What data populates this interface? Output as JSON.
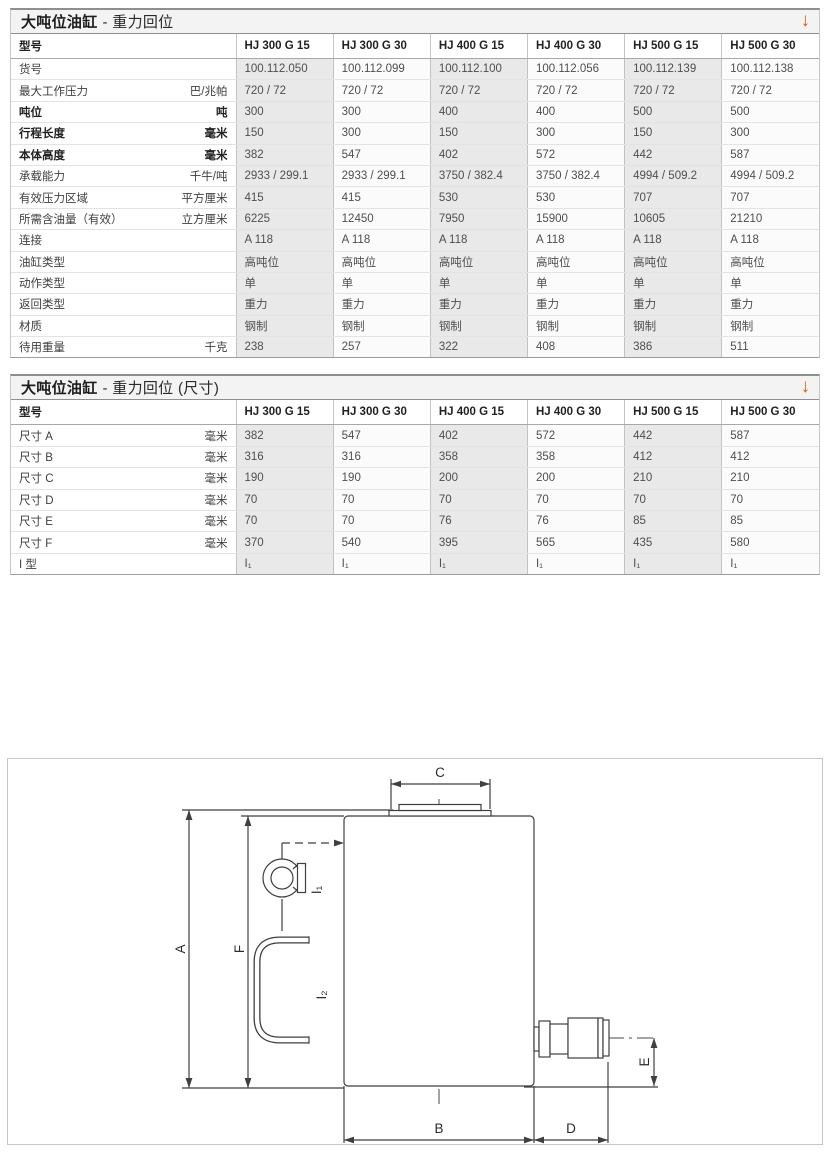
{
  "accent_color": "#e8590c",
  "page_background": "#ffffff",
  "table1": {
    "title_bold": "大吨位油缸",
    "title_rest": "- 重力回位",
    "arrow_glyph": "↓",
    "model_header": "型号",
    "columns": [
      "HJ 300 G 15",
      "HJ 300 G 30",
      "HJ 400 G 15",
      "HJ 400 G 30",
      "HJ 500 G 15",
      "HJ 500 G 30"
    ],
    "rows": [
      {
        "label": "货号",
        "unit": "",
        "bold": false,
        "values": [
          "100.112.050",
          "100.112.099",
          "100.112.100",
          "100.112.056",
          "100.112.139",
          "100.112.138"
        ]
      },
      {
        "label": "最大工作压力",
        "unit": "巴/兆帕",
        "bold": false,
        "values": [
          "720 / 72",
          "720 / 72",
          "720 / 72",
          "720 / 72",
          "720 / 72",
          "720 / 72"
        ]
      },
      {
        "label": "吨位",
        "unit": "吨",
        "bold": true,
        "values": [
          "300",
          "300",
          "400",
          "400",
          "500",
          "500"
        ]
      },
      {
        "label": "行程长度",
        "unit": "毫米",
        "bold": true,
        "values": [
          "150",
          "300",
          "150",
          "300",
          "150",
          "300"
        ]
      },
      {
        "label": "本体高度",
        "unit": "毫米",
        "bold": true,
        "values": [
          "382",
          "547",
          "402",
          "572",
          "442",
          "587"
        ]
      },
      {
        "label": "承载能力",
        "unit": "千牛/吨",
        "bold": false,
        "values": [
          "2933 / 299.1",
          "2933 / 299.1",
          "3750 / 382.4",
          "3750 / 382.4",
          "4994 / 509.2",
          "4994 / 509.2"
        ]
      },
      {
        "label": "有效压力区域",
        "unit": "平方厘米",
        "bold": false,
        "values": [
          "415",
          "415",
          "530",
          "530",
          "707",
          "707"
        ]
      },
      {
        "label": "所需含油量（有效）",
        "unit": "立方厘米",
        "bold": false,
        "values": [
          "6225",
          "12450",
          "7950",
          "15900",
          "10605",
          "21210"
        ]
      },
      {
        "label": "连接",
        "unit": "",
        "bold": false,
        "values": [
          "A 118",
          "A 118",
          "A 118",
          "A 118",
          "A 118",
          "A 118"
        ]
      },
      {
        "label": "油缸类型",
        "unit": "",
        "bold": false,
        "values": [
          "高吨位",
          "高吨位",
          "高吨位",
          "高吨位",
          "高吨位",
          "高吨位"
        ]
      },
      {
        "label": "动作类型",
        "unit": "",
        "bold": false,
        "values": [
          "单",
          "单",
          "单",
          "单",
          "单",
          "单"
        ]
      },
      {
        "label": "返回类型",
        "unit": "",
        "bold": false,
        "values": [
          "重力",
          "重力",
          "重力",
          "重力",
          "重力",
          "重力"
        ]
      },
      {
        "label": "材质",
        "unit": "",
        "bold": false,
        "values": [
          "钢制",
          "钢制",
          "钢制",
          "钢制",
          "钢制",
          "钢制"
        ]
      },
      {
        "label": "待用重量",
        "unit": "千克",
        "bold": false,
        "values": [
          "238",
          "257",
          "322",
          "408",
          "386",
          "511"
        ]
      }
    ]
  },
  "table2": {
    "title_bold": "大吨位油缸",
    "title_rest": "- 重力回位 (尺寸)",
    "arrow_glyph": "↓",
    "model_header": "型号",
    "columns": [
      "HJ 300 G 15",
      "HJ 300 G 30",
      "HJ 400 G 15",
      "HJ 400 G 30",
      "HJ 500 G 15",
      "HJ 500 G 30"
    ],
    "rows": [
      {
        "label": "尺寸 A",
        "unit": "毫米",
        "bold": false,
        "values": [
          "382",
          "547",
          "402",
          "572",
          "442",
          "587"
        ]
      },
      {
        "label": "尺寸 B",
        "unit": "毫米",
        "bold": false,
        "values": [
          "316",
          "316",
          "358",
          "358",
          "412",
          "412"
        ]
      },
      {
        "label": "尺寸 C",
        "unit": "毫米",
        "bold": false,
        "values": [
          "190",
          "190",
          "200",
          "200",
          "210",
          "210"
        ]
      },
      {
        "label": "尺寸 D",
        "unit": "毫米",
        "bold": false,
        "values": [
          "70",
          "70",
          "70",
          "70",
          "70",
          "70"
        ]
      },
      {
        "label": "尺寸 E",
        "unit": "毫米",
        "bold": false,
        "values": [
          "70",
          "70",
          "76",
          "76",
          "85",
          "85"
        ]
      },
      {
        "label": "尺寸 F",
        "unit": "毫米",
        "bold": false,
        "values": [
          "370",
          "540",
          "395",
          "565",
          "435",
          "580"
        ]
      },
      {
        "label": "I 型",
        "unit": "",
        "bold": false,
        "values": [
          "I₁",
          "I₁",
          "I₁",
          "I₁",
          "I₁",
          "I₁"
        ]
      }
    ]
  },
  "diagram": {
    "dimension_labels": {
      "A": "A",
      "B": "B",
      "C": "C",
      "D": "D",
      "E": "E",
      "F": "F"
    },
    "feature_labels": {
      "I1": "I₁",
      "I2": "I₂"
    }
  }
}
